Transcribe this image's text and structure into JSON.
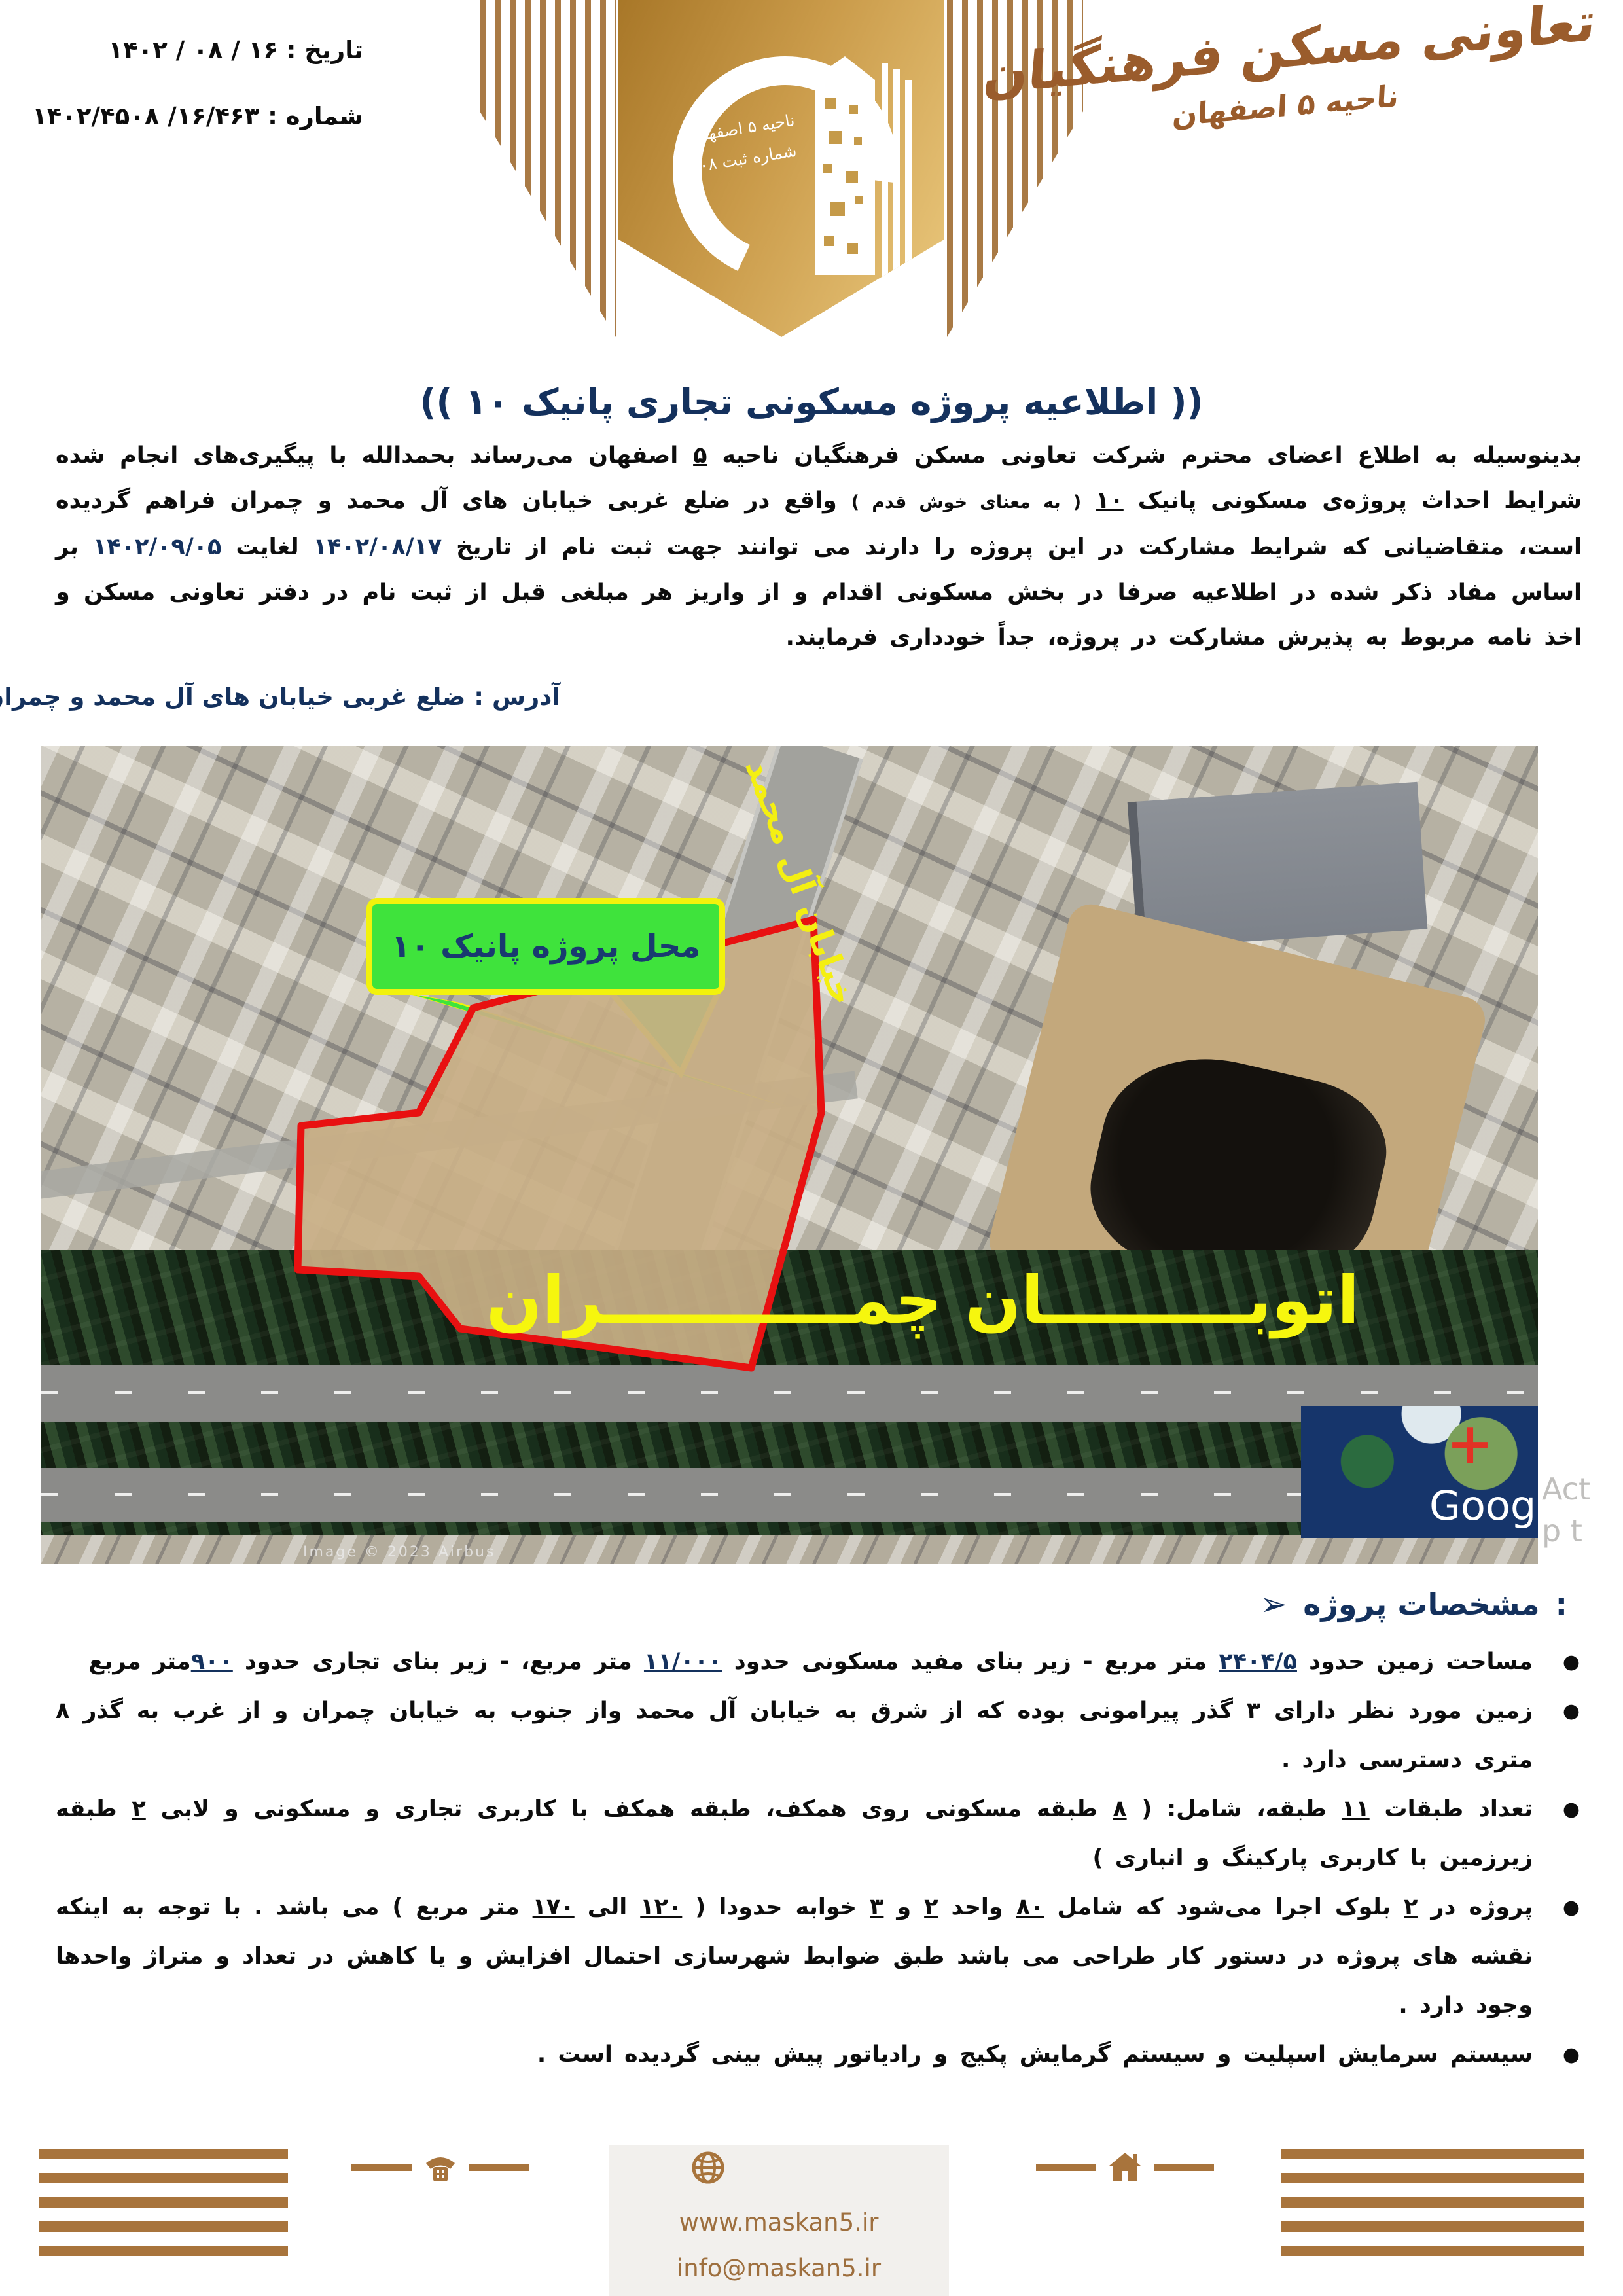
{
  "header": {
    "date_label": "تاریخ : ۱۶ / ۰۸ / ۱۴۰۲",
    "number_label": "شماره : ۱۶/۴۶۳/ ۱۴۰۲/۴۵۰۸",
    "logo": {
      "district_line": "ناحیه ۵ اصفهان",
      "reg_line": "شماره ثبت ۴۵۰۸"
    },
    "brand": {
      "calligraphy": "تعاونی مسکن فرهنگیان",
      "district": "ناحیه ۵ اصفهان"
    }
  },
  "title": "(( اطلاعیه پروژه مسکونی تجاری پانیک ۱۰ ))",
  "intro_segments": [
    {
      "t": "بدینوسیله به اطلاع اعضای محترم شرکت تعاونی مسکن فرهنگیان ناحیه ",
      "s": ""
    },
    {
      "t": "۵",
      "s": "u"
    },
    {
      "t": " اصفهان می‌رساند بحمدالله با پیگیری‌های انجام شده  شرایط احداث پروژه‌ی مسکونی پانیک ",
      "s": ""
    },
    {
      "t": "۱۰",
      "s": "u"
    },
    {
      "t": " ",
      "s": ""
    },
    {
      "t": "( به معنای خوش قدم )",
      "s": "sm"
    },
    {
      "t": " واقع در ضلع غربی خیابان های آل محمد  و چمران فراهم گردیده است، متقاضیانی که شرایط مشارکت در این پروژه را دارند می توانند جهت ثبت نام از تاریخ ",
      "s": ""
    },
    {
      "t": "۱۴۰۲/۰۸/۱۷",
      "s": "n"
    },
    {
      "t": " لغایت ",
      "s": ""
    },
    {
      "t": "۱۴۰۲/۰۹/۰۵",
      "s": "n"
    },
    {
      "t": " بر اساس مفاد ذکر شده در اطلاعیه صرفا در بخش مسکونی اقدام و از واریز هر مبلغی قبل از ثبت نام در دفتر تعاونی مسکن و اخذ نامه مربوط به پذیرش مشارکت در پروژه، جداً خودداری فرمایند.",
      "s": ""
    }
  ],
  "address": {
    "label": "آدرس : ضلع غربی خیابان های آل محمد  و چمران"
  },
  "map": {
    "callout": "محل پروژه پانیک ۱۰",
    "street_label": "خیابان آل محمد",
    "highway_label": "اتوبـــــــــان چمـــــــــــران",
    "watermark": "Google",
    "marker_plus": "+",
    "attribution": "Image © 2023 Airbus",
    "side_note_1": "Act",
    "side_note_2": "p t"
  },
  "specs": {
    "arrow": "➢",
    "heading": "مشخصات پروژه",
    "colon": ":",
    "items": [
      {
        "segments": [
          {
            "t": "مساحت زمین حدود ",
            "s": ""
          },
          {
            "t": "۲۴۰۴/۵",
            "s": "nu"
          },
          {
            "t": " متر مربع -  زیر بنای مفید مسکونی حدود ",
            "s": ""
          },
          {
            "t": "۱۱/۰۰۰",
            "s": "nu"
          },
          {
            "t": " متر مربع، -  زیر بنای تجاری حدود ",
            "s": ""
          },
          {
            "t": "۹۰۰",
            "s": "nu"
          },
          {
            "t": "متر مربع",
            "s": ""
          }
        ]
      },
      {
        "segments": [
          {
            "t": "زمین مورد نظر دارای ۳ گذر پیرامونی بوده که از شرق  به خیابان آل محمد واز جنوب به  خیابان چمران  و از غرب به گذر ۸  متری دسترسی دارد .",
            "s": ""
          }
        ]
      },
      {
        "segments": [
          {
            "t": "تعداد طبقات ",
            "s": ""
          },
          {
            "t": "۱۱",
            "s": "u"
          },
          {
            "t": " طبقه، شامل: ( ",
            "s": ""
          },
          {
            "t": "۸",
            "s": "u"
          },
          {
            "t": " طبقه مسکونی روی همکف، طبقه همکف با کاربری تجاری و مسکونی و لابی ",
            "s": ""
          },
          {
            "t": "۲",
            "s": "u"
          },
          {
            "t": " طبقه زیرزمین با کاربری پارکینگ و انباری )",
            "s": ""
          }
        ]
      },
      {
        "segments": [
          {
            "t": "پروژه در ",
            "s": ""
          },
          {
            "t": "۲",
            "s": "u"
          },
          {
            "t": " بلوک اجرا می‌شود که شامل ",
            "s": ""
          },
          {
            "t": "۸۰",
            "s": "u"
          },
          {
            "t": " واحد ",
            "s": ""
          },
          {
            "t": "۲",
            "s": "u"
          },
          {
            "t": " و ",
            "s": ""
          },
          {
            "t": "۳",
            "s": "u"
          },
          {
            "t": " خوابه حدودا ( ",
            "s": ""
          },
          {
            "t": "۱۲۰",
            "s": "u"
          },
          {
            "t": " الی ",
            "s": ""
          },
          {
            "t": "۱۷۰",
            "s": "u"
          },
          {
            "t": " متر مربع ) می باشد . با توجه به اینکه نقشه های پروژه در دستور کار طراحی می باشد طبق ضوابط شهرسازی احتمال افزایش و یا کاهش  در تعداد و متراژ واحدها وجود دارد .",
            "s": ""
          }
        ]
      },
      {
        "segments": [
          {
            "t": "سیستم سرمایش اسپلیت و سیستم گرمایش پکیج و رادیاتور پیش بینی گردیده است .",
            "s": ""
          }
        ]
      }
    ]
  },
  "footer": {
    "website": "www.maskan5.ir",
    "email": "info@maskan5.ir"
  },
  "colors": {
    "navy": "#14315d",
    "brown": "#a8743c",
    "calligraphy_brown": "#9a5c2c",
    "gold_shield": "#ca9b4a",
    "callout_green": "#3fe33c",
    "annotation_yellow": "#f6f60e",
    "plot_red": "#e81111"
  }
}
